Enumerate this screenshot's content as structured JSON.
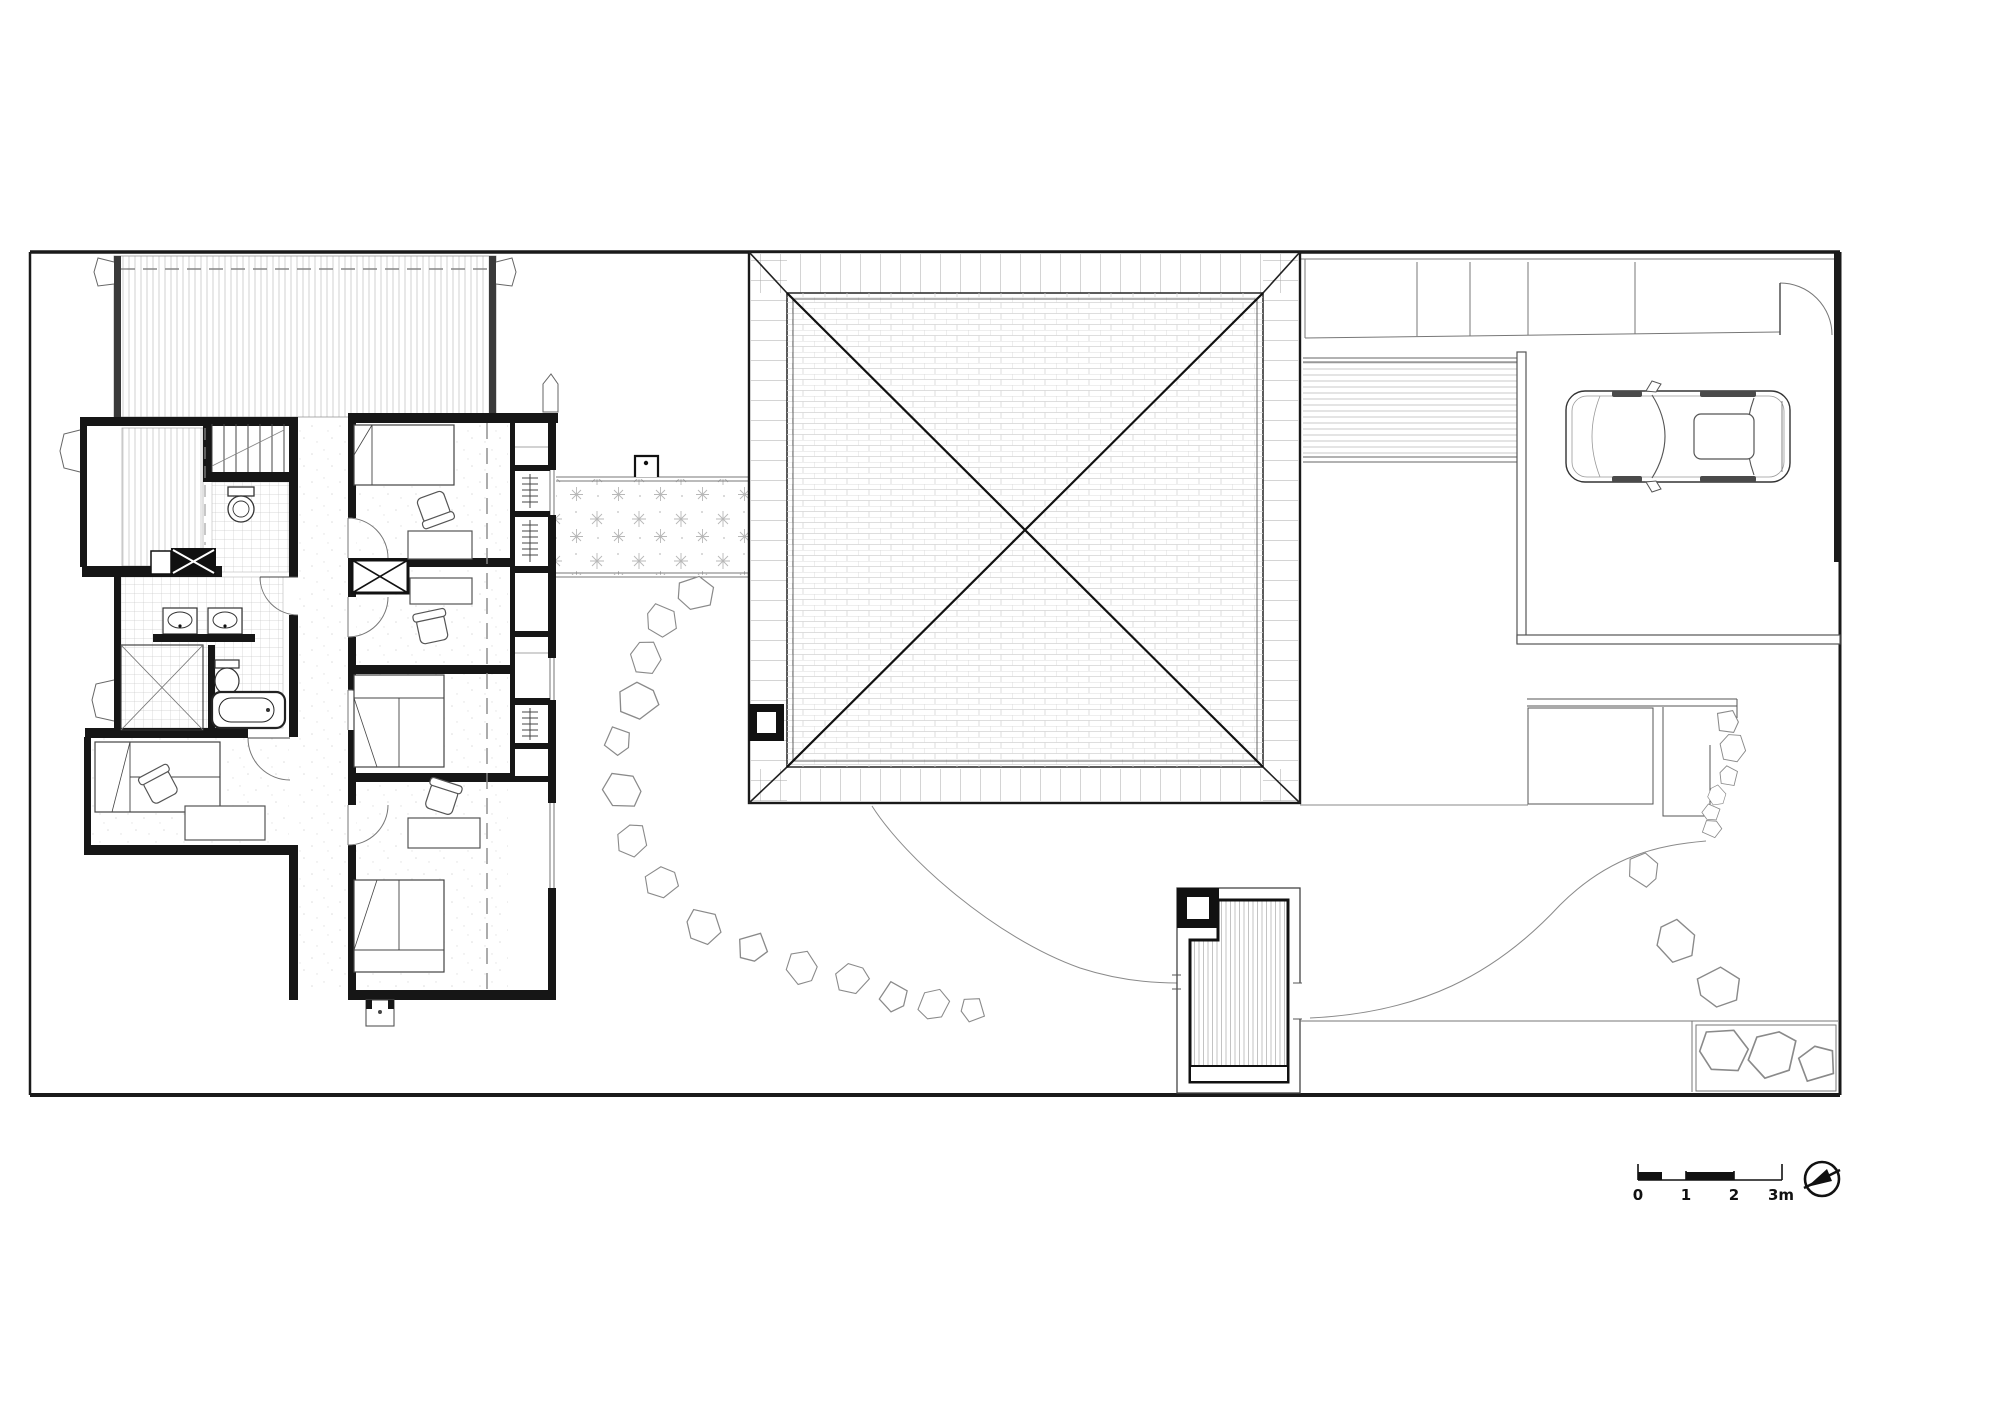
{
  "document": {
    "kind": "architectural site and floor plan, top view",
    "paper_color": "#ffffff",
    "ink_color": "#1a1a1a",
    "texture_color": "#c8c8c8"
  },
  "scale_bar": {
    "unit": "meters",
    "labels": [
      "0",
      "1",
      "2",
      "3m"
    ]
  },
  "icons": {
    "compass": "north-arrow",
    "scale": "scale-bar"
  }
}
